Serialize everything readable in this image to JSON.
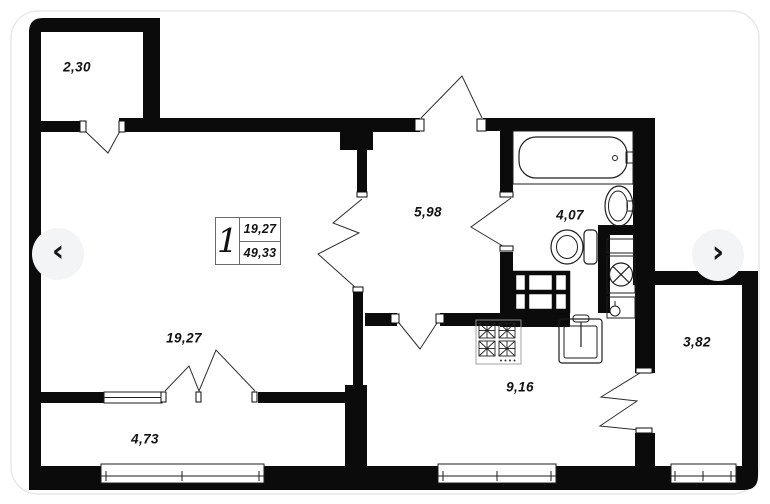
{
  "viewer": {
    "prev_button": {
      "icon": "chevron-left-icon",
      "glyph": "‹"
    },
    "next_button": {
      "icon": "chevron-right-icon",
      "glyph": "›"
    }
  },
  "plan": {
    "unit_summary": {
      "rooms_count": "1",
      "living_area": "19,27",
      "total_area": "49,33"
    },
    "rooms": [
      {
        "name": "balcony-top",
        "area": "2,30"
      },
      {
        "name": "living-room",
        "area": "19,27"
      },
      {
        "name": "hallway",
        "area": "5,98"
      },
      {
        "name": "bathroom",
        "area": "4,07"
      },
      {
        "name": "kitchen",
        "area": "9,16"
      },
      {
        "name": "storage-right",
        "area": "3,82"
      },
      {
        "name": "balcony-bottom",
        "area": "4,73"
      }
    ],
    "fixtures": [
      "bathtub-icon",
      "bath-sink-icon",
      "toilet-icon",
      "washing-machine-icon",
      "boiler-icon",
      "wardrobe-icon",
      "stove-icon",
      "kitchen-sink-icon"
    ]
  },
  "colors": {
    "wall": "#0b0b0c",
    "card_bg": "#ffffff",
    "card_border": "#e8e8e8",
    "arrow_bg": "#f3f4f6",
    "text": "#121212"
  }
}
